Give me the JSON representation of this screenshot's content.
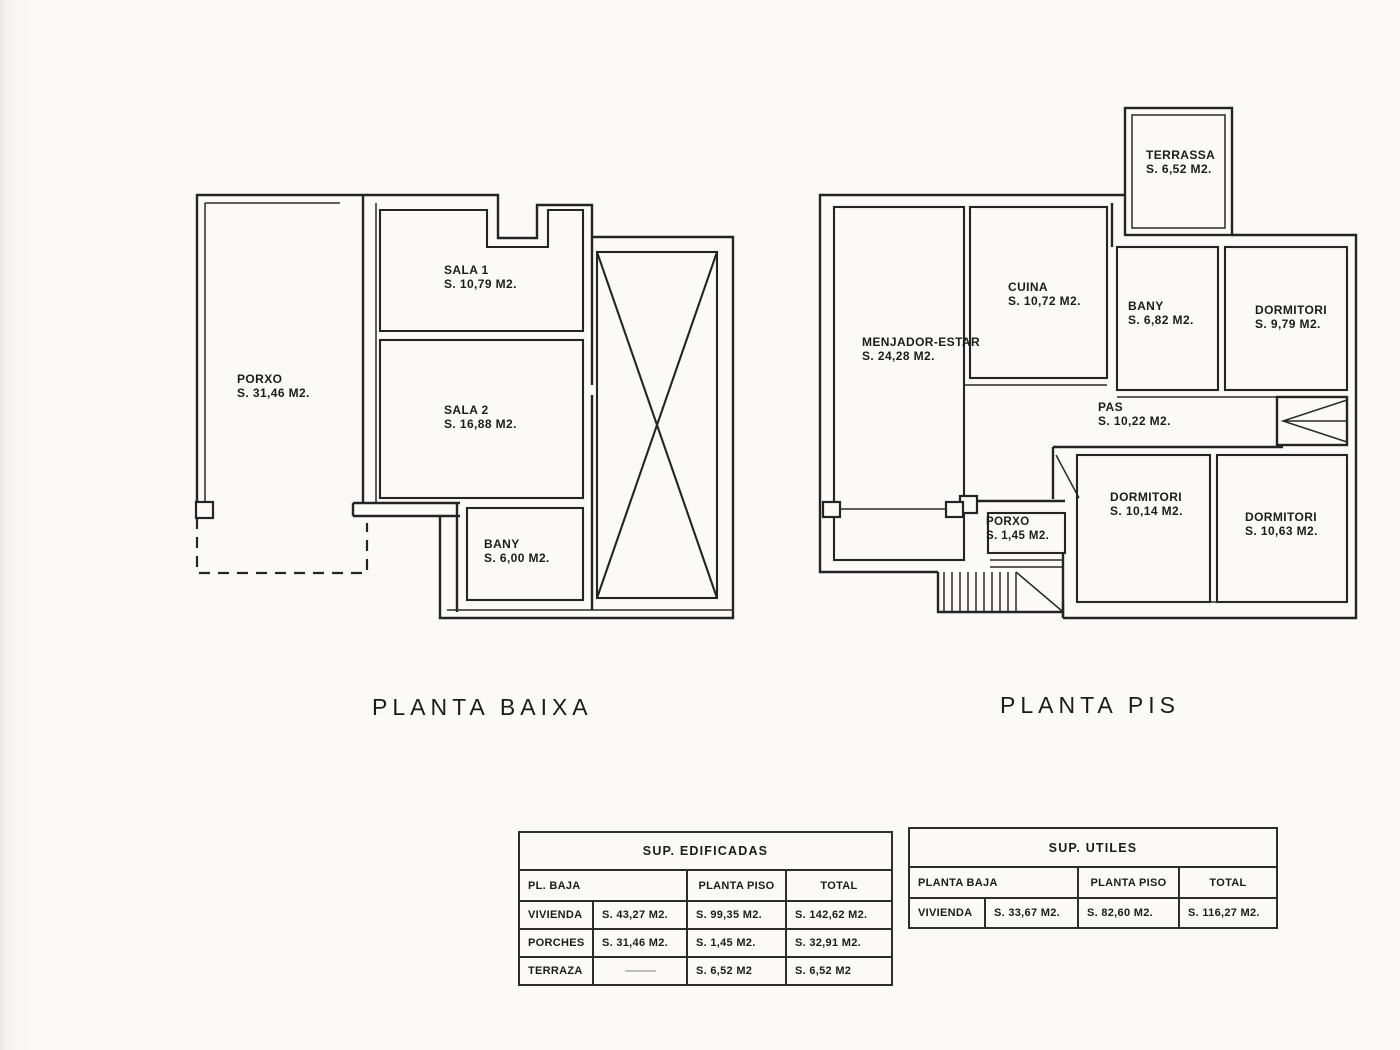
{
  "plans": {
    "planta_baixa": {
      "title": "PLANTA BAIXA",
      "rooms": [
        {
          "name": "PORXO",
          "area": "S. 31,46 M2."
        },
        {
          "name": "SALA 1",
          "area": "S. 10,79 M2."
        },
        {
          "name": "SALA 2",
          "area": "S. 16,88 M2."
        },
        {
          "name": "BANY",
          "area": "S. 6,00 M2."
        }
      ]
    },
    "planta_pis": {
      "title": "PLANTA PIS",
      "rooms": [
        {
          "name": "TERRASSA",
          "area": "S. 6,52 M2."
        },
        {
          "name": "MENJADOR-ESTAR",
          "area": "S. 24,28 M2."
        },
        {
          "name": "CUINA",
          "area": "S. 10,72 M2."
        },
        {
          "name": "BANY",
          "area": "S. 6,82 M2."
        },
        {
          "name": "DORMITORI",
          "area": "S. 9,79 M2."
        },
        {
          "name": "PAS",
          "area": "S. 10,22 M2."
        },
        {
          "name": "PORXO",
          "area": "S. 1,45 M2."
        },
        {
          "name": "DORMITORI",
          "area": "S. 10,14 M2."
        },
        {
          "name": "DORMITORI",
          "area": "S. 10,63 M2."
        }
      ]
    }
  },
  "tables": {
    "edificadas": {
      "title": "SUP. EDIFICADAS",
      "col_headers": [
        "PL. BAJA",
        "PLANTA PISO",
        "TOTAL"
      ],
      "rows": [
        [
          "VIVIENDA",
          "S. 43,27 M2.",
          "S. 99,35 M2.",
          "S. 142,62 M2."
        ],
        [
          "PORCHES",
          "S. 31,46 M2.",
          "S. 1,45 M2.",
          "S. 32,91 M2."
        ],
        [
          "TERRAZA",
          "———",
          "S. 6,52 M2",
          "S. 6,52 M2"
        ]
      ]
    },
    "utiles": {
      "title": "SUP. UTILES",
      "col_headers": [
        "PLANTA BAJA",
        "PLANTA PISO",
        "TOTAL"
      ],
      "rows": [
        [
          "VIVIENDA",
          "S. 33,67 M2.",
          "S. 82,60 M2.",
          "S. 116,27 M2."
        ]
      ]
    }
  }
}
